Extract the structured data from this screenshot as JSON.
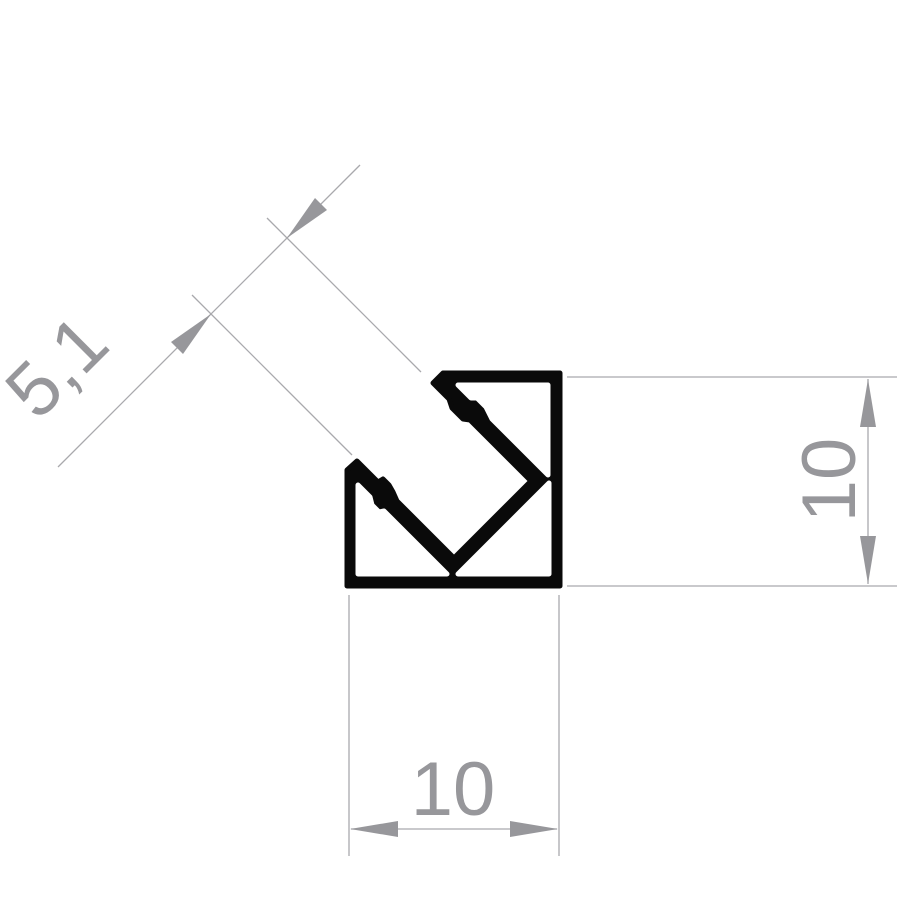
{
  "drawing": {
    "type": "profile-cross-section-technical-drawing",
    "colors": {
      "bg": "#ffffff",
      "ink": "#0a0a0a",
      "dim": "#97979b",
      "dimline": "#a9a9ad"
    },
    "dimensions": {
      "diagonal": {
        "value": "5,1"
      },
      "right": {
        "value": "10"
      },
      "bottom": {
        "value": "10"
      }
    }
  }
}
